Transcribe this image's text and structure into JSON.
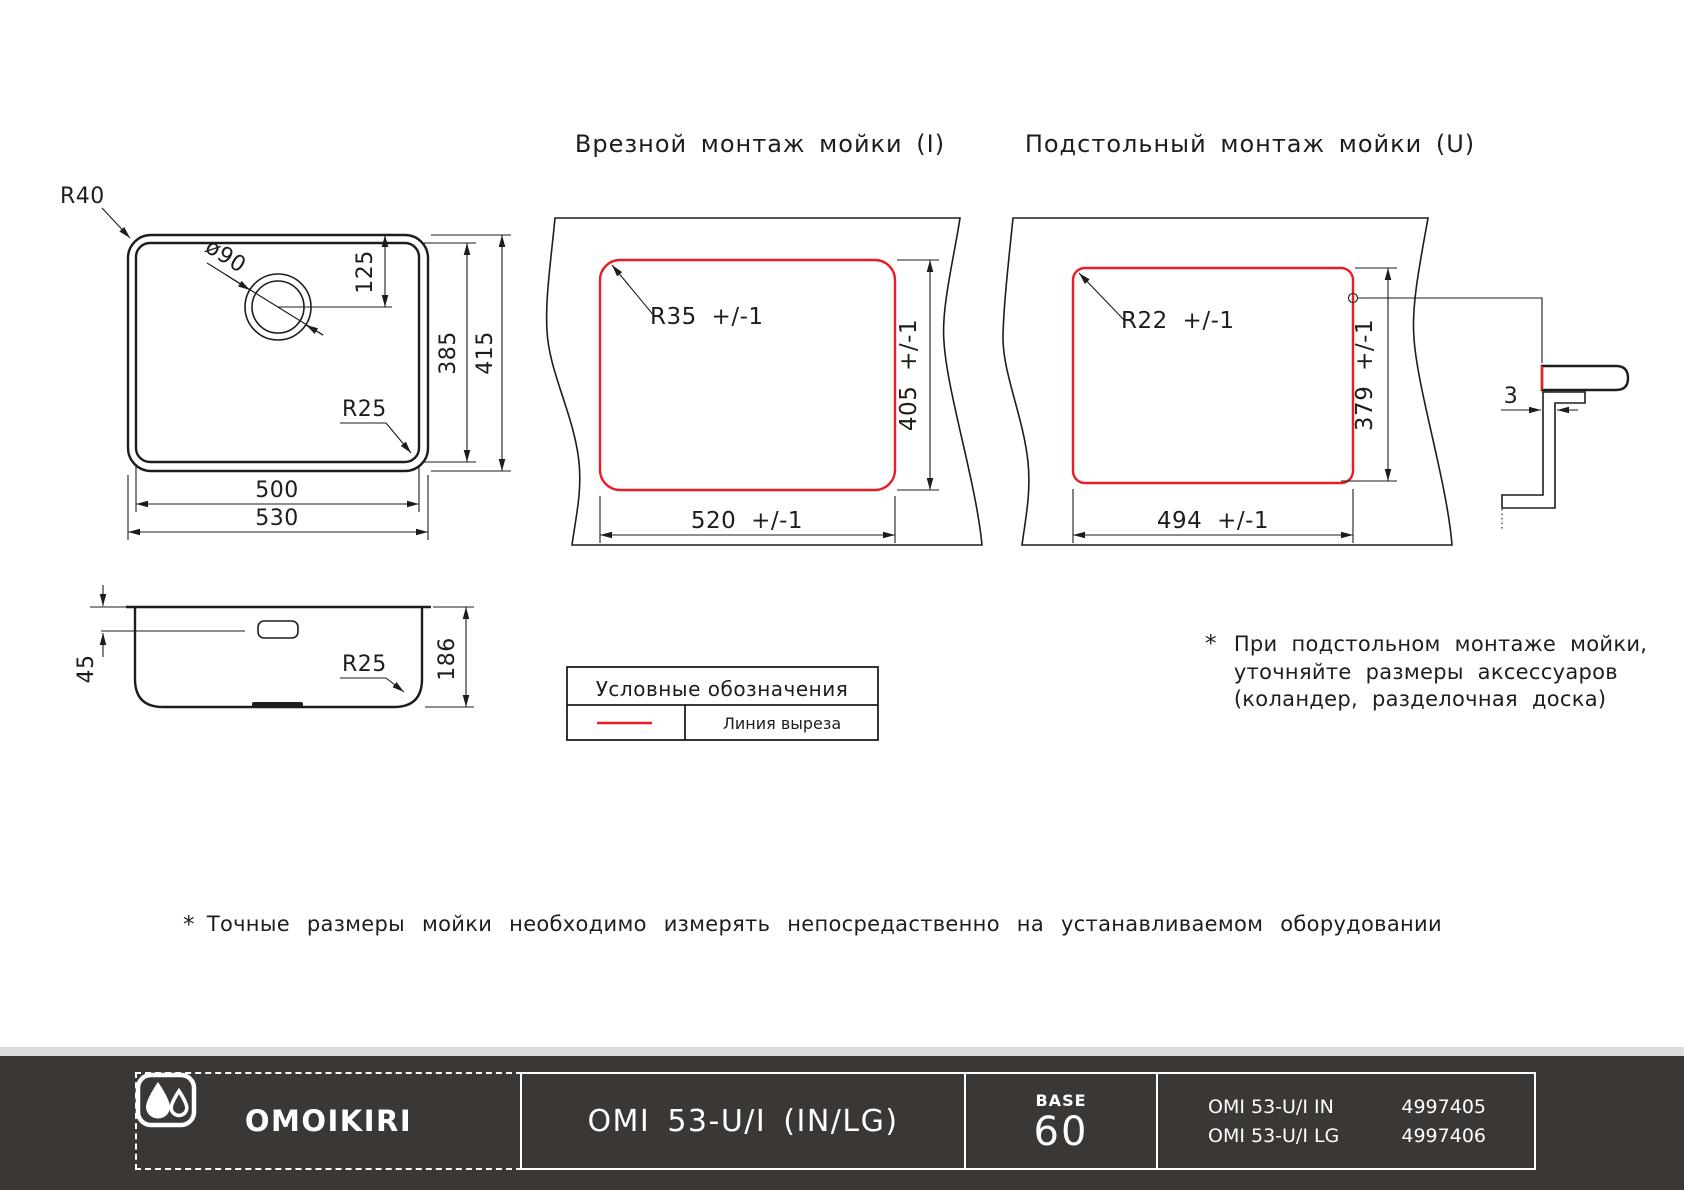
{
  "colors": {
    "bg": "#ffffff",
    "line": "#1d1d1b",
    "cut": "#ec1c24",
    "footer_bg": "#3b3734",
    "footer_fg": "#ffffff",
    "strip": "#dcdcdc"
  },
  "titles": {
    "inset": "Врезной монтаж мойки (I)",
    "undermount": "Подстольный монтаж мойки (U)"
  },
  "top_view": {
    "r_outer": "R40",
    "drain_dia": "ø90",
    "drain_offset": "125",
    "bowl_h": "385",
    "outer_h": "415",
    "r_inner": "R25",
    "bowl_w": "500",
    "outer_w": "530"
  },
  "side_view": {
    "overflow_depth": "45",
    "depth": "186",
    "r_bottom": "R25"
  },
  "inset_cutout": {
    "radius": "R35 +/-1",
    "height": "405 +/-1",
    "width": "520 +/-1"
  },
  "undermount_cutout": {
    "radius": "R22 +/-1",
    "height": "379 +/-1",
    "width": "494 +/-1",
    "edge_gap": "3"
  },
  "legend": {
    "title": "Условные обозначения",
    "cut_line_label": "Линия выреза"
  },
  "notes": {
    "star": "*",
    "undermount_lines": [
      "При подстольном монтаже мойки,",
      "уточняйте размеры аксессуаров",
      "(коландер, разделочная доска)"
    ],
    "bottom": "Точные размеры мойки необходимо измерять непосредаственно на устанавливаемом оборудовании"
  },
  "footer": {
    "brand": "OMOIKIRI",
    "model": "OMI 53-U/I (IN/LG)",
    "base_label": "BASE",
    "base_value": "60",
    "skus": [
      {
        "name": "OMI 53-U/I IN",
        "code": "4997405"
      },
      {
        "name": "OMI 53-U/I LG",
        "code": "4997406"
      }
    ]
  }
}
